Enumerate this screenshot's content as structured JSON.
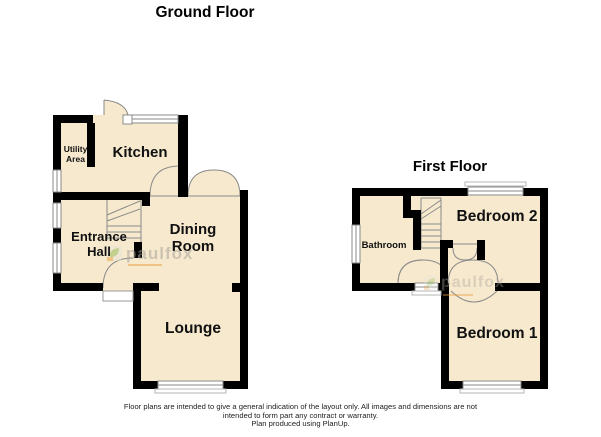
{
  "ground_floor": {
    "title": "Ground Floor",
    "rooms": {
      "utility": {
        "label": "Utility Area"
      },
      "kitchen": {
        "label": "Kitchen"
      },
      "entrance_hall": {
        "label": "Entrance Hall"
      },
      "dining_room": {
        "label": "Dining Room"
      },
      "lounge": {
        "label": "Lounge"
      }
    }
  },
  "first_floor": {
    "title": "First Floor",
    "rooms": {
      "bathroom": {
        "label": "Bathroom"
      },
      "bedroom2": {
        "label": "Bedroom 2"
      },
      "bedroom1": {
        "label": "Bedroom 1"
      }
    }
  },
  "watermark": {
    "brand": "paulfox"
  },
  "footer": {
    "line1": "Floor plans are intended to give a general indication of the layout only. All images and dimensions are not",
    "line2": "intended to form part any contract or warranty.",
    "line3": "Plan produced using PlanUp."
  },
  "colors": {
    "room_fill": "#f7e9ce",
    "wall": "#000000",
    "thin_line": "#8a8a8a",
    "watermark_green": "#8cbb4e",
    "watermark_orange": "#e89b3c"
  }
}
